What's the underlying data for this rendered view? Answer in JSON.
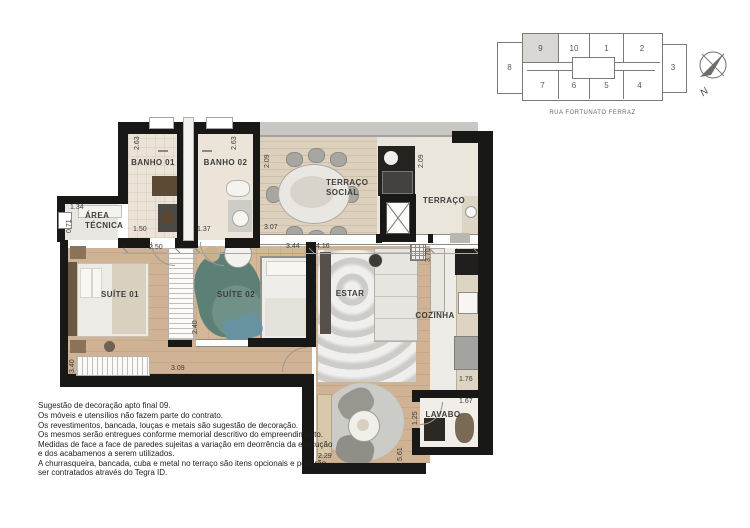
{
  "keyplan": {
    "street": "RUA FORTUNATO FERRAZ",
    "north_label": "N",
    "highlighted_unit": "9",
    "units": {
      "left": "8",
      "right": "3",
      "top": [
        "9",
        "10",
        "1",
        "2"
      ],
      "bottom": [
        "7",
        "6",
        "5",
        "4"
      ]
    }
  },
  "plan": {
    "rooms": {
      "banho01": "BANHO 01",
      "banho02": "BANHO 02",
      "terraco_social_line1": "TERRAÇO",
      "terraco_social_line2": "SOCIAL",
      "terraco": "TERRAÇO",
      "area_tecnica_line1": "ÁREA",
      "area_tecnica_line2": "TÉCNICA",
      "suite01": "SUÍTE 01",
      "suite02": "SUÍTE 02",
      "estar": "ESTAR",
      "cozinha": "COZINHA",
      "lavabo": "LAVABO"
    },
    "dims": {
      "banho01_h": "2.63",
      "banho02_h": "2.63",
      "banho01_w": "1.50",
      "banho02_w": "1.37",
      "terraco_social_h": "2.09",
      "terraco_social_w": "3.07",
      "terraco_h": "2.09",
      "area_tecnica_w": "1.34",
      "area_tecnica_h": "0.71",
      "suite01_top": "2.50",
      "suite01_h": "3.40",
      "suite01_w": "3.09",
      "suite02_top": "3.44",
      "suite02_h": "2.40",
      "estar_top": "4.16",
      "estar_w": "2.29",
      "estar_h": "5.61",
      "cozinha_h": "3.70",
      "cozinha_w": "1.76",
      "lavabo_w": "1.67",
      "lavabo_h": "1.25"
    }
  },
  "disclaimer": {
    "lines": [
      "Sugestão de decoração apto final 09.",
      "Os móveis e utensílios não fazem parte do contrato.",
      "Os revestimentos, bancada, louças e metais são sugestão de decoração.",
      "Os mesmos serão entregues conforme memorial descritivo do empreendimento.",
      "Medidas de face a face de paredes sujeitas a variação em deorrência da execução",
      "e dos acabamenos a serem utilizados.",
      "A churrasqueira, bancada, cuba e metal no terraço são itens opcionais e poderão",
      "ser contratados através do Tegra ID."
    ]
  },
  "colors": {
    "wall": "#181816",
    "wood_floor": "#d1b595",
    "terrace_deck": "#ddd1be",
    "keyplan_highlight": "#d8d7d4",
    "plant_accent": "#5d8076"
  }
}
